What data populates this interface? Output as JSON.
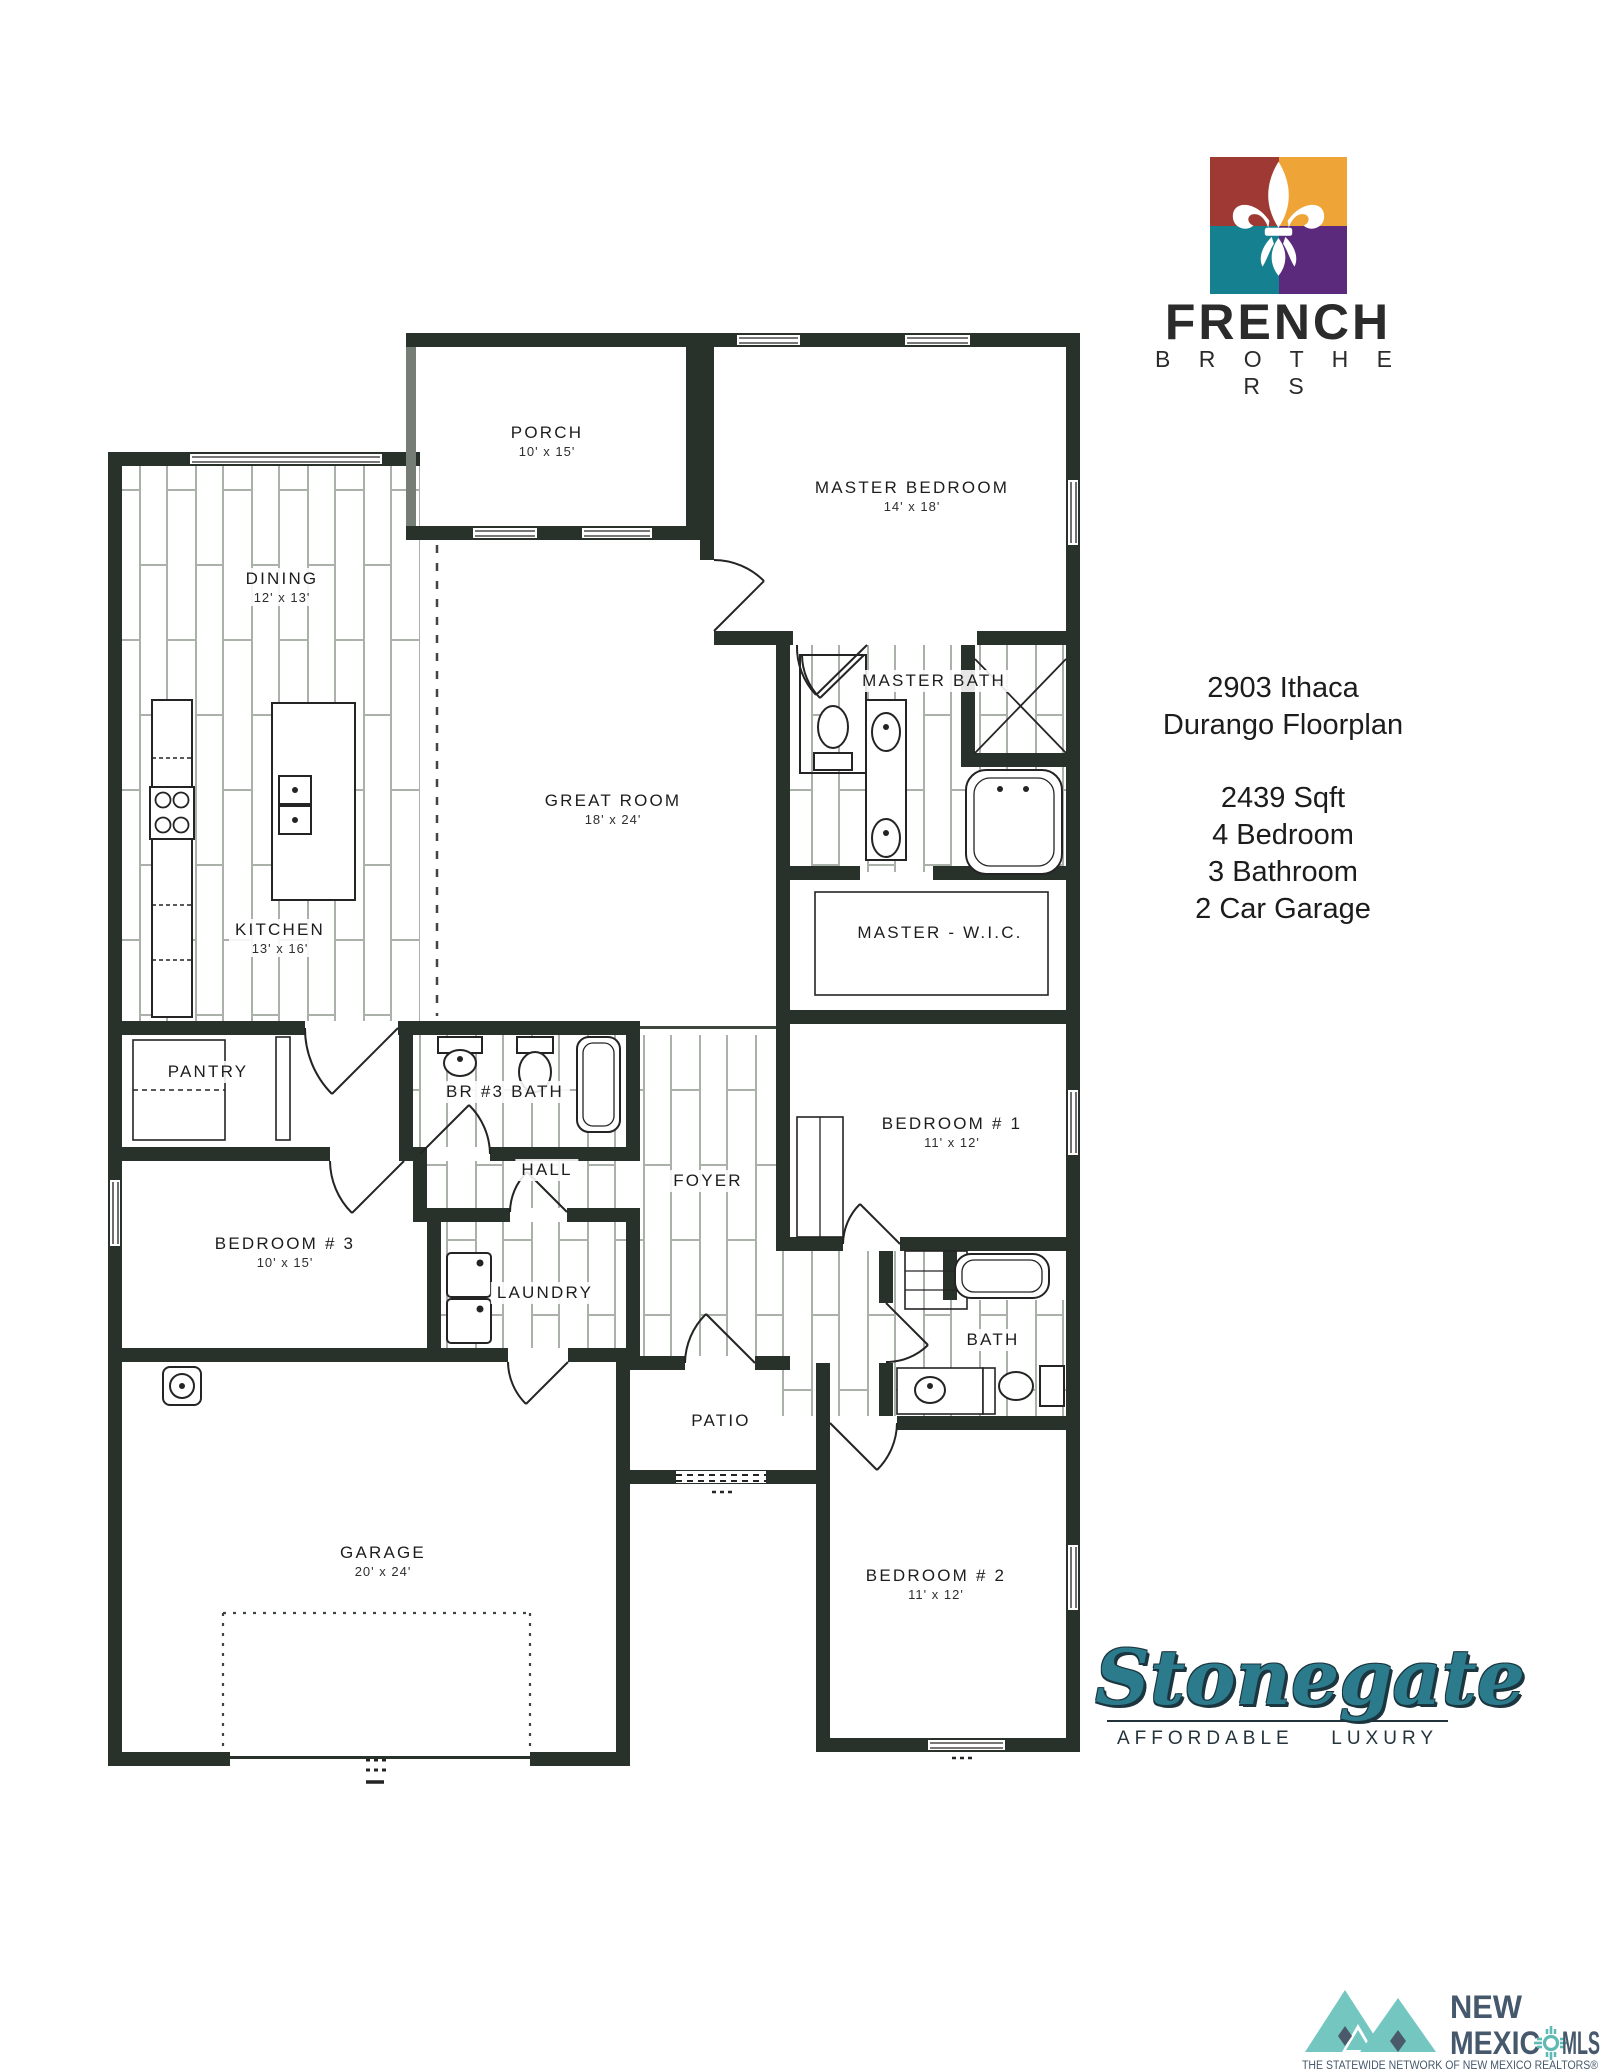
{
  "branding": {
    "logo_text_top": "FRENCH",
    "logo_text_bottom": "B R O T H E R S"
  },
  "info": {
    "address": "2903 Ithaca",
    "plan": "Durango Floorplan",
    "sqft": "2439 Sqft",
    "beds": "4 Bedroom",
    "baths": "3 Bathroom",
    "garage": "2 Car Garage"
  },
  "rooms": [
    {
      "id": "porch",
      "name": "PORCH",
      "dims": "10' x 15'"
    },
    {
      "id": "master-bedroom",
      "name": "MASTER BEDROOM",
      "dims": "14' x 18'"
    },
    {
      "id": "dining",
      "name": "DINING",
      "dims": "12' x 13'"
    },
    {
      "id": "great-room",
      "name": "GREAT ROOM",
      "dims": "18' x 24'"
    },
    {
      "id": "master-bath",
      "name": "MASTER BATH",
      "dims": ""
    },
    {
      "id": "kitchen",
      "name": "KITCHEN",
      "dims": "13' x 16'"
    },
    {
      "id": "master-wic",
      "name": "MASTER - W.I.C.",
      "dims": ""
    },
    {
      "id": "pantry",
      "name": "PANTRY",
      "dims": ""
    },
    {
      "id": "br3-bath",
      "name": "BR #3 BATH",
      "dims": ""
    },
    {
      "id": "hall",
      "name": "HALL",
      "dims": ""
    },
    {
      "id": "foyer",
      "name": "FOYER",
      "dims": ""
    },
    {
      "id": "bedroom-1",
      "name": "BEDROOM # 1",
      "dims": "11' x 12'"
    },
    {
      "id": "bedroom-3",
      "name": "BEDROOM # 3",
      "dims": "10' x 15'"
    },
    {
      "id": "laundry",
      "name": "LAUNDRY",
      "dims": ""
    },
    {
      "id": "bath",
      "name": "BATH",
      "dims": ""
    },
    {
      "id": "patio",
      "name": "PATIO",
      "dims": ""
    },
    {
      "id": "garage",
      "name": "GARAGE",
      "dims": "20' x 24'"
    },
    {
      "id": "bedroom-2",
      "name": "BEDROOM # 2",
      "dims": "11' x 12'"
    }
  ],
  "stonegate": {
    "name": "Stonegate",
    "tagline_left": "AFFORDABLE",
    "tagline_right": "LUXURY"
  },
  "mls": {
    "line1": "NEW",
    "line2_left": "MEXIC",
    "line2_right": "MLS",
    "tagline": "THE STATEWIDE NETWORK OF NEW MEXICO REALTORS®"
  },
  "palette": {
    "wall": "#28322a",
    "tile_line": "#aab1a8",
    "logo_maroon": "#9e3a33",
    "logo_orange": "#efa437",
    "logo_teal": "#15808f",
    "logo_purple": "#5c2a7c",
    "stonegate_teal": "#2b7b8c",
    "mls_slate": "#46586b",
    "mls_teal": "#74c7c1"
  }
}
